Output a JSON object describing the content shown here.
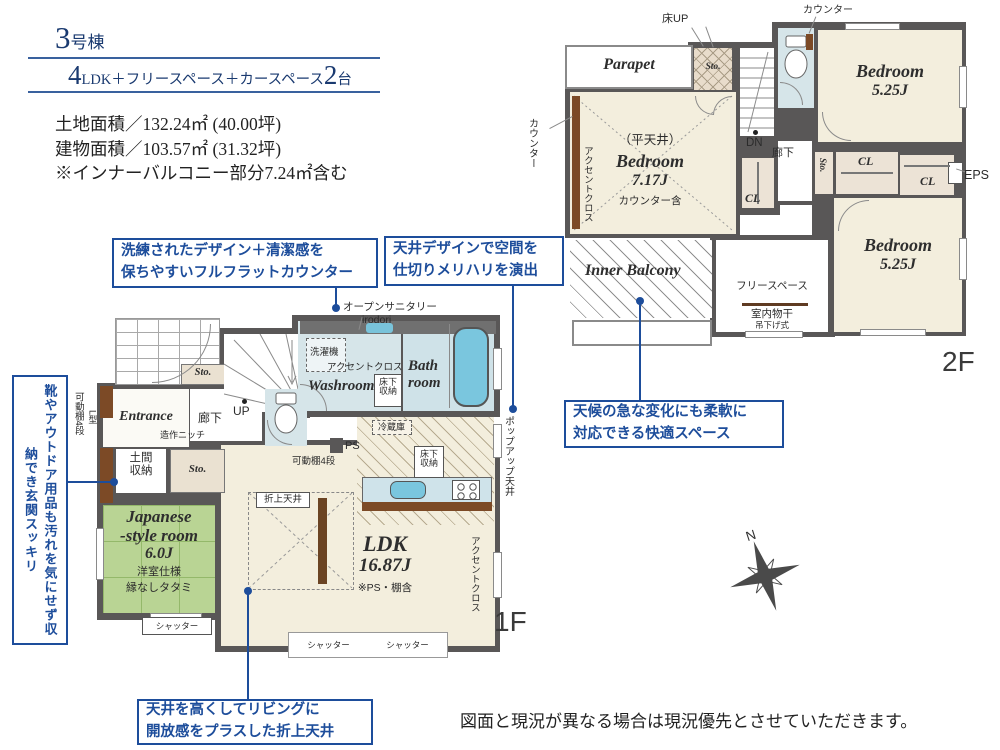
{
  "header": {
    "unit_number": "3",
    "unit_suffix": "号棟",
    "plan_big1": "4",
    "plan_mid": "LDK＋フリースペース＋カースペース",
    "plan_big2": "2",
    "plan_suffix": "台",
    "land_area": "土地面積／132.24㎡ (40.00坪)",
    "building_area": "建物面積／103.57㎡ (31.32坪)",
    "area_note": "※インナーバルコニー部分7.24㎡含む"
  },
  "callouts": {
    "counter": [
      "洗練されたデザイン＋清潔感を",
      "保ちやすいフルフラットカウンター"
    ],
    "ceiling_design": [
      "天井デザインで空間を",
      "仕切りメリハリを演出"
    ],
    "weather": [
      "天候の急な変化にも柔軟に",
      "対応できる快適スペース"
    ],
    "entrance_storage": "靴やアウトドア用品も汚れを気にせず収納でき玄関スッキリ",
    "living_ceiling": [
      "天井を高くしてリビングに",
      "開放感をプラスした折上天井"
    ]
  },
  "floor1": {
    "floor_label": "1F",
    "entrance": "Entrance",
    "sto": "Sto.",
    "hallway": "廊下",
    "niche": "造作ニッチ",
    "up": "UP",
    "doma1": "土間",
    "doma2": "収納",
    "shelf": "可動棚4段",
    "l_type": "L型",
    "jp1": "Japanese",
    "jp2": "-style room",
    "jp3": "6.0J",
    "jp_note1": "洋室仕様",
    "jp_note2": "縁なしタタミ",
    "shutter": "シャッター",
    "open_sanitary": "オープンサニタリー",
    "irodori": "irodori",
    "washer": "洗濯機",
    "accent": "アクセントクロス",
    "washroom": "Washroom",
    "yukashita1": "床下",
    "yukashita2": "収納",
    "bath1": "Bath",
    "bath2": "room",
    "fridge": "冷蔵庫",
    "ps": "PS",
    "popup": "ポップアップ天井",
    "oriage": "折上天井",
    "ldk": "LDK",
    "ldk_size": "16.87J",
    "ldk_note": "※PS・棚含"
  },
  "floor2": {
    "floor_label": "2F",
    "floor_up": "床UP",
    "parapet": "Parapet",
    "sto": "Sto.",
    "dn": "DN",
    "counter": "カウンター",
    "bedroom": "Bedroom",
    "size_525": "5.25J",
    "size_717": "7.17J",
    "flat_ceiling": "（平天井）",
    "counter_incl": "カウンター含",
    "accent": "アクセントクロス",
    "cl": "CL",
    "hallway": "廊下",
    "eps": "EPS",
    "inner_balcony": "Inner Balcony",
    "free_space": "フリースペース",
    "laundry": "室内物干",
    "laundry_sub": "吊下げ式"
  },
  "compass": {
    "north": "N"
  },
  "disclaimer": "図面と現況が異なる場合は現況優先とさせていただきます。"
}
